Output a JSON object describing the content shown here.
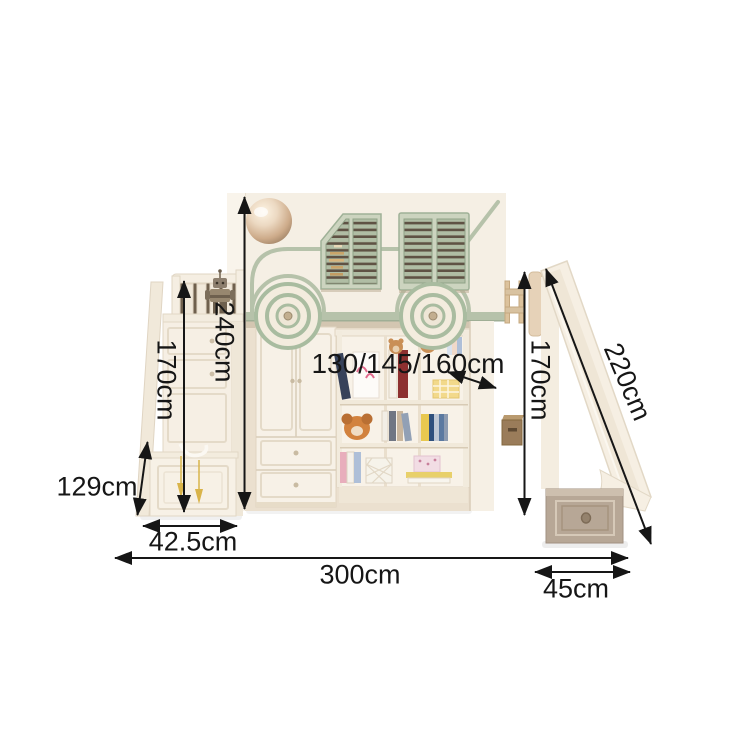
{
  "product": {
    "name": "kids-bus-loft-bed-with-slide",
    "description": "Dimension diagram of a cream bus-themed loft bed with storage staircase, wardrobe, bookshelf and slide"
  },
  "dimensions": {
    "overall_height": "240cm",
    "staircase_height": "170cm",
    "staircase_side_height": "129cm",
    "staircase_depth": "42.5cm",
    "overall_width": "300cm",
    "slide_platform_height": "170cm",
    "slide_length": "220cm",
    "slide_width": "45cm",
    "mattress_width_options": "130/145/160cm"
  },
  "colors": {
    "background": "#ffffff",
    "annotation": "#161616",
    "bed_cream": "#f5efe4",
    "alcove_shadow": "#ebe0cf",
    "sage_green_trim": "#b6c2aa",
    "shutter_sage": "#b0bda4",
    "shutter_gap_dark": "#5f5244",
    "slide_box_greige": "#b7a796",
    "gate_wood": "#dcc29c",
    "tassel_gold": "#d9b44a"
  }
}
